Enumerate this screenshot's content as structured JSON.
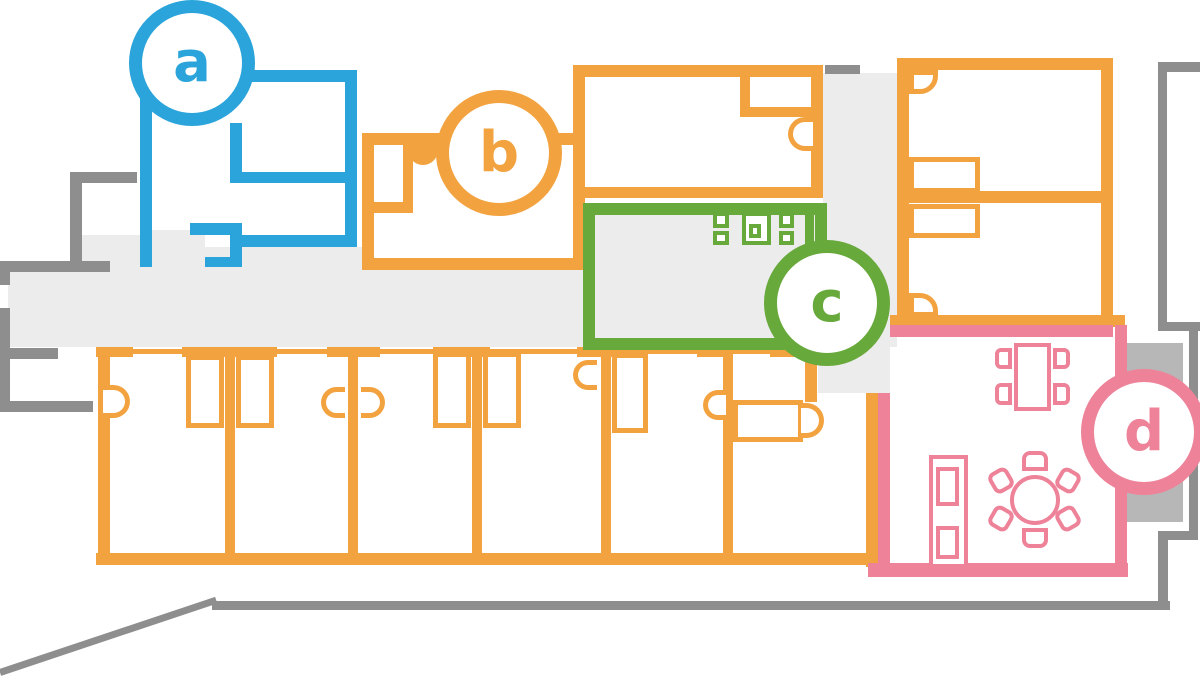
{
  "title": "hotel-floor-plan",
  "badges": [
    {
      "id": "a",
      "label": "a",
      "color": "#2aa4da"
    },
    {
      "id": "b",
      "label": "b",
      "color": "#f2a340"
    },
    {
      "id": "c",
      "label": "c",
      "color": "#68a93c"
    },
    {
      "id": "d",
      "label": "d",
      "color": "#ee8298"
    }
  ],
  "colors": {
    "room_a_blue": "#2aa4da",
    "rooms_orange": "#f2a340",
    "room_c_green": "#68a93c",
    "room_d_pink": "#ee8298",
    "exterior_wall_gray": "#8e8e8e",
    "corridor_fill": "#ececec",
    "balcony_fill": "#b7b7b7",
    "background": "#ffffff"
  }
}
